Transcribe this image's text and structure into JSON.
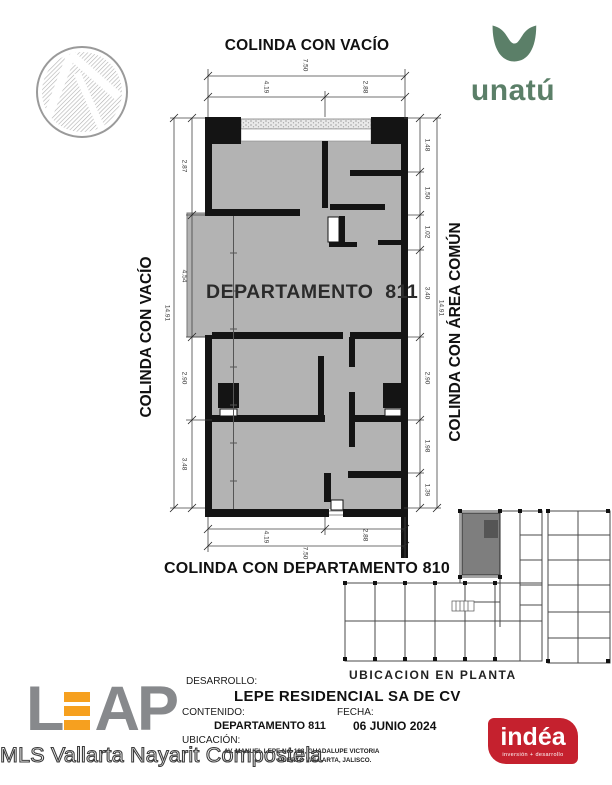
{
  "header": {
    "top_boundary": "COLINDA CON VACÍO",
    "unatu_wordmark": "unatú"
  },
  "plan": {
    "title": "DEPARTAMENTO  811",
    "left_boundary": "COLINDA CON VACÍO",
    "right_boundary": "COLINDA CON ÁREA COMÚN",
    "bottom_boundary": "COLINDA CON DEPARTAMENTO 810",
    "dims": {
      "top_total": "7.50",
      "top_segments": [
        "4.19",
        "2.88"
      ],
      "bottom_segments": [
        "4.19",
        "2.88"
      ],
      "bottom_total": "7.50",
      "left_segments": [
        "2.87",
        "4.54",
        "2.90",
        "3.48"
      ],
      "left_total": "14.91",
      "right_segments": [
        "1.48",
        "1.50",
        "1.02",
        "3.40",
        "2.90",
        "1.98",
        "1.39"
      ],
      "right_total": "14.91"
    }
  },
  "keyplan": {
    "caption": "UBICACION EN PLANTA"
  },
  "titleblock": {
    "desarrollo_label": "DESARROLLO:",
    "desarrollo_value": "LEPE RESIDENCIAL SA DE CV",
    "contenido_label": "CONTENIDO:",
    "contenido_value": "DEPARTAMENTO 811",
    "fecha_label": "FECHA:",
    "fecha_value": "06 JUNIO 2024",
    "ubicacion_label": "UBICACIÓN:",
    "ubicacion_line1": "AV. MANUEL LEPE No. 188, GUADALUPE VICTORIA",
    "ubicacion_line2": "PUERTO VALLARTA, JALISCO."
  },
  "branding": {
    "leap_l": "L",
    "leap_ap": "AP",
    "indea_name": "indéa",
    "indea_tagline": "inversión + desarrollo"
  },
  "watermark": "MLS Vallarta Nayarit Compostela",
  "colors": {
    "unatu_green": "#5b7f68",
    "leap_gray": "#87898c",
    "leap_orange": "#f6a01f",
    "indea_red": "#c5212e",
    "plan_floor_gray": "#b3b3b3",
    "wall_black": "#141414",
    "keyplan_highlight_gray": "#7e7e7e"
  }
}
